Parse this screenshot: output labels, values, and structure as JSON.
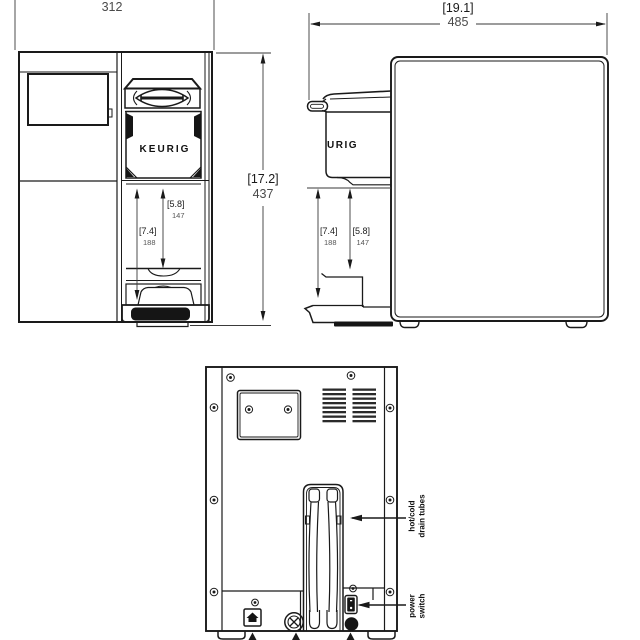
{
  "drawing_title": "Keurig brewer dimension drawing",
  "brand": {
    "front_logo": "KEURIG",
    "side_logo_partial": "URIG"
  },
  "front_view": {
    "width_mm": "312",
    "height_in": "[17.2]",
    "height_mm": "437",
    "inner_clearance_in": "[5.8]",
    "inner_clearance_mm": "147",
    "outer_clearance_in": "[7.4]",
    "outer_clearance_mm": "188"
  },
  "side_view": {
    "depth_in": "[19.1]",
    "depth_mm": "485",
    "outer_clearance_in": "[7.4]",
    "outer_clearance_mm": "188",
    "inner_clearance_in": "[5.8]",
    "inner_clearance_mm": "147"
  },
  "back_view": {
    "drain_label": [
      "hot/cold",
      "drain tubes"
    ],
    "power_label": [
      "power",
      "switch"
    ]
  }
}
